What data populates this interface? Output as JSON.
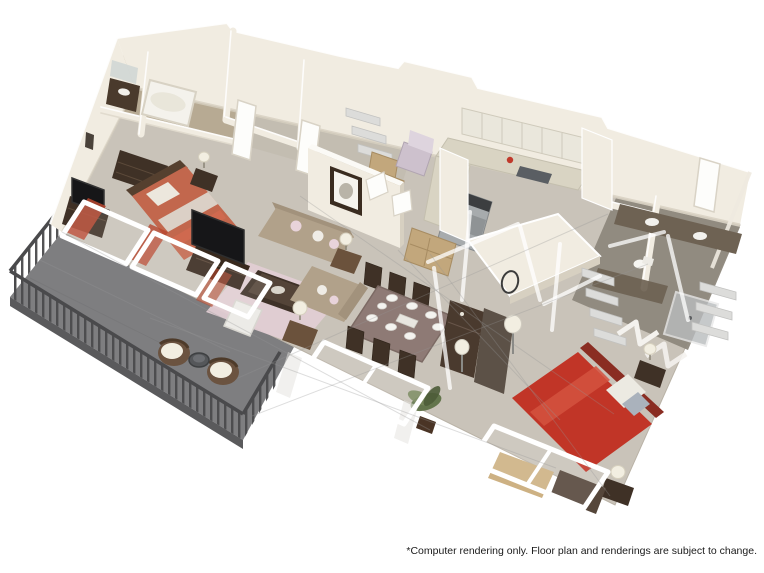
{
  "page": {
    "background": "#ffffff"
  },
  "disclaimer": {
    "text": "*Computer rendering only. Floor plan and renderings are subject to change."
  },
  "floorplan": {
    "description": "3D isometric cutaway rendering of a two-bedroom two-bath apartment with balcony",
    "rooms": [
      {
        "id": "balcony",
        "label": "Balcony",
        "contents": [
          "metal railing",
          "two wicker chairs",
          "bistro table"
        ]
      },
      {
        "id": "master-bedroom",
        "label": "Master Bedroom",
        "contents": [
          "coral bed",
          "dresser with tv",
          "dresser",
          "nightstand lamp",
          "sliding glass doors with orange curtains"
        ]
      },
      {
        "id": "master-bathroom",
        "label": "Master Bathroom",
        "contents": [
          "bathtub",
          "vanity with mirror"
        ]
      },
      {
        "id": "walk-in-closet",
        "label": "Walk-in Closet",
        "contents": [
          "shelving",
          "white doors"
        ]
      },
      {
        "id": "storage-laundry",
        "label": "Storage / Laundry Room",
        "contents": [
          "boxes",
          "lilac armchair",
          "open double doors",
          "framed picture on outer wall"
        ]
      },
      {
        "id": "kitchen",
        "label": "Kitchen",
        "contents": [
          "u-shaped counter",
          "upper cabinets",
          "range",
          "sink",
          "tan hutch cabinet"
        ]
      },
      {
        "id": "living-room",
        "label": "Living Room",
        "contents": [
          "tan sofa",
          "tan loveseat",
          "white armchair",
          "pink area rug",
          "coffee table",
          "tv on media console",
          "two side tables with lamps",
          "potted palm",
          "front wall windows shown as ghosted white frames"
        ]
      },
      {
        "id": "dining-area",
        "label": "Dining Area",
        "contents": [
          "dining table with tablecloth and eight place settings",
          "wood chairs"
        ]
      },
      {
        "id": "hallway",
        "label": "Hallway",
        "contents": [
          "console",
          "round mirror",
          "floor lamps"
        ]
      },
      {
        "id": "bathroom-2",
        "label": "Second Bathroom",
        "contents": [
          "vanity counters with sinks",
          "toilet",
          "shower",
          "linen shelves",
          "bifold closet doors"
        ]
      },
      {
        "id": "bedroom-2",
        "label": "Second Bedroom",
        "contents": [
          "red bed",
          "nightstand with lamp",
          "foot bench",
          "closet shelving",
          "window with bench rug"
        ]
      }
    ],
    "colors": {
      "background": "#ffffff",
      "text": "#1a1a1a",
      "carpet": "#c9c3b9",
      "wall": "#f1ece1",
      "wall_top": "#fbfaf6",
      "wall_shadow": "#d7d0c1",
      "bath_tan": "#b5a78f",
      "bath_gray": "#8e887c",
      "counter_brown": "#6e6253",
      "balcony": "#7e7e80",
      "balcony_edge": "#5a5a5c",
      "railing": "#4a4a4c",
      "bed_coral": "#c2674d",
      "bed_red": "#c13527",
      "headboard_red": "#8a2d22",
      "sofa": "#b1a18a",
      "sofa_dark": "#a2927c",
      "rug": "#e1ced3",
      "wood_dark": "#3f3126",
      "wood_mid": "#6b523c",
      "tablecloth": "#8e7a75",
      "cabinet_tan": "#c2a77c",
      "steel": "#a7abad",
      "plant": "#5e7146",
      "lamp": "#f2eee1",
      "curtain": "#b8472f",
      "lilac": "#cdc1cd",
      "white_frame": "#ffffff",
      "shelf": "#dcdcda",
      "door_white": "#fdfdfb",
      "plate": "#f4f3ef",
      "screen": "#161618",
      "ghost": "rgba(150,150,148,0.32)",
      "ghost_white": "rgba(255,255,255,0.75)"
    }
  }
}
